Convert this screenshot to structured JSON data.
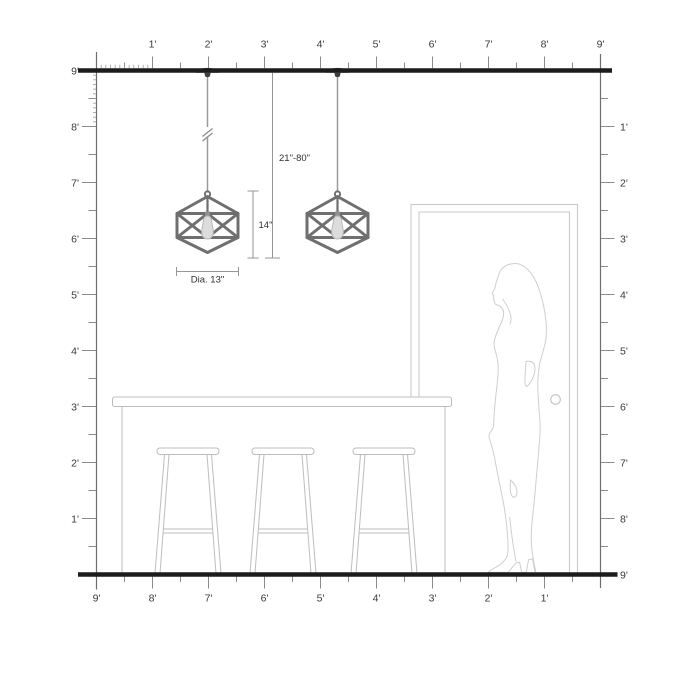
{
  "diagram_name": "pendant-light-scale-diagram",
  "rulers": {
    "top": {
      "labels": [
        "1'",
        "2'",
        "3'",
        "4'",
        "5'",
        "6'",
        "7'",
        "8'",
        "9'"
      ]
    },
    "left": {
      "labels": [
        "9'",
        "8'",
        "7'",
        "6'",
        "5'",
        "4'",
        "3'",
        "2'",
        "1'"
      ]
    },
    "right": {
      "labels": [
        "1'",
        "2'",
        "3'",
        "4'",
        "5'",
        "6'",
        "7'",
        "8'",
        "9'"
      ]
    },
    "bottom": {
      "labels": [
        "9'",
        "8'",
        "7'",
        "6'",
        "5'",
        "4'",
        "3'",
        "2'",
        "1'"
      ]
    }
  },
  "annotations": {
    "cord_length_range": "21\"-80\"",
    "fixture_height": "14\"",
    "fixture_diameter": "Dia. 13\""
  },
  "colors": {
    "ceiling_floor_line": "#1c1c1c",
    "ruler_line": "#8c8c8c",
    "ruler_text": "#3a3a3a",
    "fixture_frame": "#6f6f6f",
    "canopy": "#3f3f3f",
    "bulb_fill": "#dcdcdc",
    "dimension_line": "#969696",
    "dimension_text": "#2f2f2f",
    "furniture_outline": "#bdbdbd",
    "door_outline": "#c9c9c9",
    "silhouette_outline": "#cfcfcf",
    "background": "#ffffff"
  }
}
